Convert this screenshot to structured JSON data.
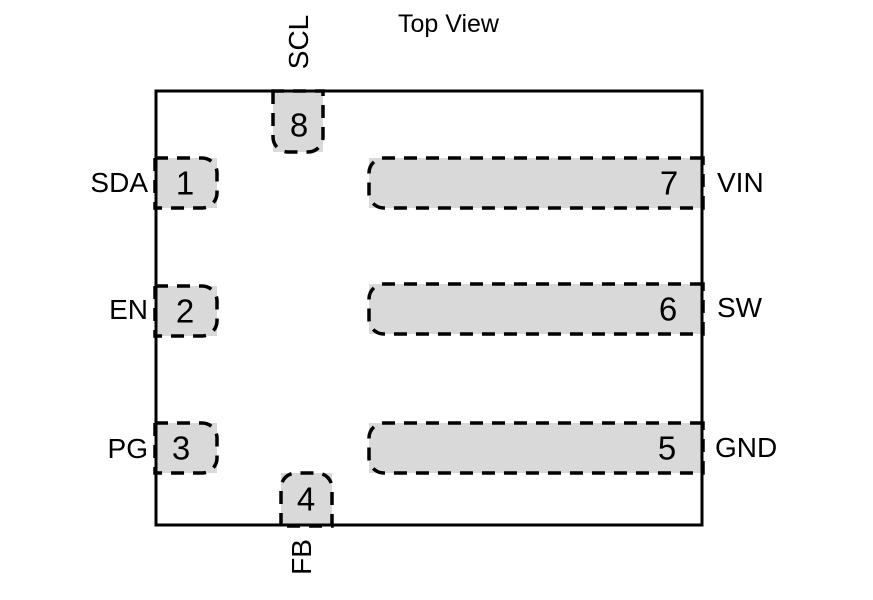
{
  "title": "Top View",
  "colors": {
    "pad_fill": "#d9d9d9",
    "line": "#000000",
    "background": "#ffffff"
  },
  "pins": {
    "p1": {
      "number": "1",
      "label": "SDA"
    },
    "p2": {
      "number": "2",
      "label": "EN"
    },
    "p3": {
      "number": "3",
      "label": "PG"
    },
    "p4": {
      "number": "4",
      "label": "FB"
    },
    "p5": {
      "number": "5",
      "label": "GND"
    },
    "p6": {
      "number": "6",
      "label": "SW"
    },
    "p7": {
      "number": "7",
      "label": "VIN"
    },
    "p8": {
      "number": "8",
      "label": "SCL"
    }
  }
}
